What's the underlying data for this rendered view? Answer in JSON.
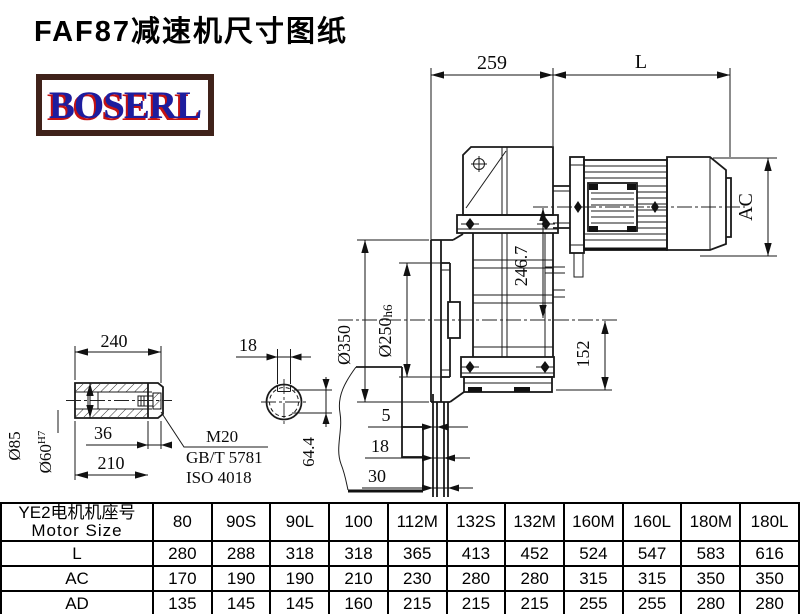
{
  "title": "FAF87减速机尺寸图纸",
  "logo": {
    "text": "BOSERL"
  },
  "drawing": {
    "shaft_view": {
      "len_total": "240",
      "len_36": "36",
      "len_210": "210",
      "dia_85": "Ø85",
      "dia_60": "Ø60",
      "dia_60_tol": "H7",
      "thread": "M20",
      "std_gb": "GB/T 5781",
      "std_iso": "ISO 4018"
    },
    "end_view": {
      "key_width": "18",
      "key_height": "64.4"
    },
    "main_view": {
      "dim_259": "259",
      "dim_L": "L",
      "dim_AC": "AC",
      "dim_246_7": "246.7",
      "dim_152": "152",
      "dia_350": "Ø350",
      "dia_250": "Ø250",
      "dia_250_tol": "h6",
      "dim_5": "5",
      "dim_18": "18",
      "dim_30": "30"
    }
  },
  "table": {
    "header_line1": "YE2电机机座号",
    "header_line2": "Motor Size",
    "columns": [
      "80",
      "90S",
      "90L",
      "100",
      "112M",
      "132S",
      "132M",
      "160M",
      "160L",
      "180M",
      "180L"
    ],
    "rows": [
      {
        "label": "L",
        "values": [
          "280",
          "288",
          "318",
          "318",
          "365",
          "413",
          "452",
          "524",
          "547",
          "583",
          "616"
        ]
      },
      {
        "label": "AC",
        "values": [
          "170",
          "190",
          "190",
          "210",
          "230",
          "280",
          "280",
          "315",
          "315",
          "350",
          "350"
        ]
      },
      {
        "label": "AD",
        "values": [
          "135",
          "145",
          "145",
          "160",
          "215",
          "215",
          "215",
          "255",
          "255",
          "280",
          "280"
        ]
      }
    ]
  }
}
